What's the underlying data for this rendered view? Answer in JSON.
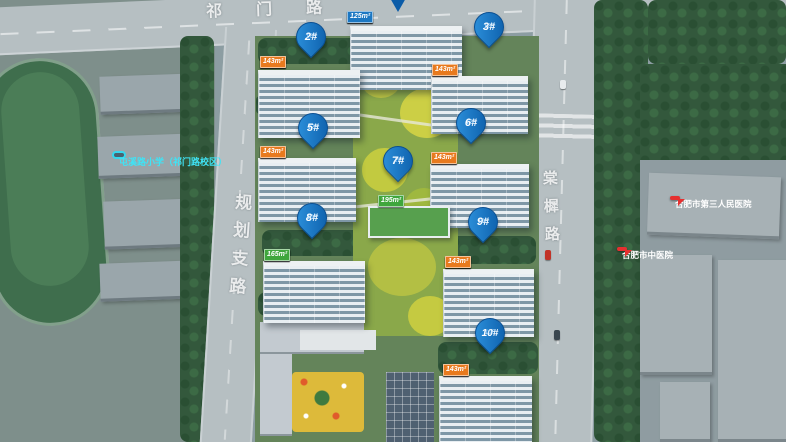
{
  "roads": {
    "top": "祁门路",
    "left": "规划支路",
    "right": "棠樨路"
  },
  "facilities": {
    "school": "屯溪路小学（祁门路校区）",
    "hospital_1": "合肥市第三人民医院",
    "hospital_2": "合肥市中医院"
  },
  "pins": [
    {
      "label": "2#",
      "sub": "17F"
    },
    {
      "label": "3#",
      "sub": "17F"
    },
    {
      "label": "5#",
      "sub": "17F"
    },
    {
      "label": "6#",
      "sub": "17F"
    },
    {
      "label": "7#",
      "sub": "2F"
    },
    {
      "label": "8#",
      "sub": "10F"
    },
    {
      "label": "9#",
      "sub": "10F"
    },
    {
      "label": "10#",
      "sub": "10F"
    }
  ],
  "tag_rows": [
    {
      "building": "1#",
      "tags": [
        {
          "text": "125m²",
          "type": "blue"
        },
        {
          "text": "165m²",
          "type": "green"
        },
        {
          "text": "195m²",
          "type": "green"
        },
        {
          "text": "125m²",
          "type": "blue"
        }
      ]
    },
    {
      "building": "2#",
      "tags": [
        {
          "text": "143m²",
          "type": "orange"
        },
        {
          "text": "125m²",
          "type": "blue"
        },
        {
          "text": "125m²",
          "type": "blue"
        },
        {
          "text": "143m²",
          "type": "orange"
        }
      ]
    },
    {
      "building": "3#",
      "tags": [
        {
          "text": "143m²",
          "type": "orange"
        },
        {
          "text": "125m²",
          "type": "blue"
        },
        {
          "text": "125m²",
          "type": "blue"
        },
        {
          "text": "143m²",
          "type": "orange"
        }
      ]
    },
    {
      "building": "5#",
      "tags": [
        {
          "text": "143m²",
          "type": "orange"
        },
        {
          "text": "125m²",
          "type": "blue"
        },
        {
          "text": "125m²",
          "type": "blue"
        },
        {
          "text": "143m²",
          "type": "orange"
        }
      ]
    },
    {
      "building": "6#",
      "tags": [
        {
          "text": "143m²",
          "type": "orange"
        },
        {
          "text": "125m²",
          "type": "blue"
        },
        {
          "text": "125m²",
          "type": "blue"
        },
        {
          "text": "143m²",
          "type": "orange"
        }
      ]
    },
    {
      "building": "7#",
      "tags": [
        {
          "text": "165m²",
          "type": "green"
        },
        {
          "text": "195m²",
          "type": "green"
        }
      ]
    },
    {
      "building": "8#",
      "tags": [
        {
          "text": "165m²",
          "type": "green"
        },
        {
          "text": "165m²",
          "type": "green"
        },
        {
          "text": "165m²",
          "type": "green"
        },
        {
          "text": "165m²",
          "type": "green"
        }
      ]
    },
    {
      "building": "9#",
      "tags": [
        {
          "text": "143m²",
          "type": "orange"
        },
        {
          "text": "125m²",
          "type": "blue"
        },
        {
          "text": "125m²",
          "type": "blue"
        },
        {
          "text": "143m²",
          "type": "orange"
        }
      ]
    },
    {
      "building": "10#",
      "tags": [
        {
          "text": "143m²",
          "type": "orange"
        },
        {
          "text": "143m²",
          "type": "orange"
        },
        {
          "text": "143m²",
          "type": "orange"
        },
        {
          "text": "143m²",
          "type": "orange"
        }
      ]
    }
  ],
  "colors": {
    "pin_blue": "#1172C4",
    "tag_orange": "#E87A1E",
    "tag_blue": "#1C77C2",
    "tag_green": "#3FA63C",
    "school_cyan": "#35D8EE",
    "hospital_red": "#E63030"
  }
}
